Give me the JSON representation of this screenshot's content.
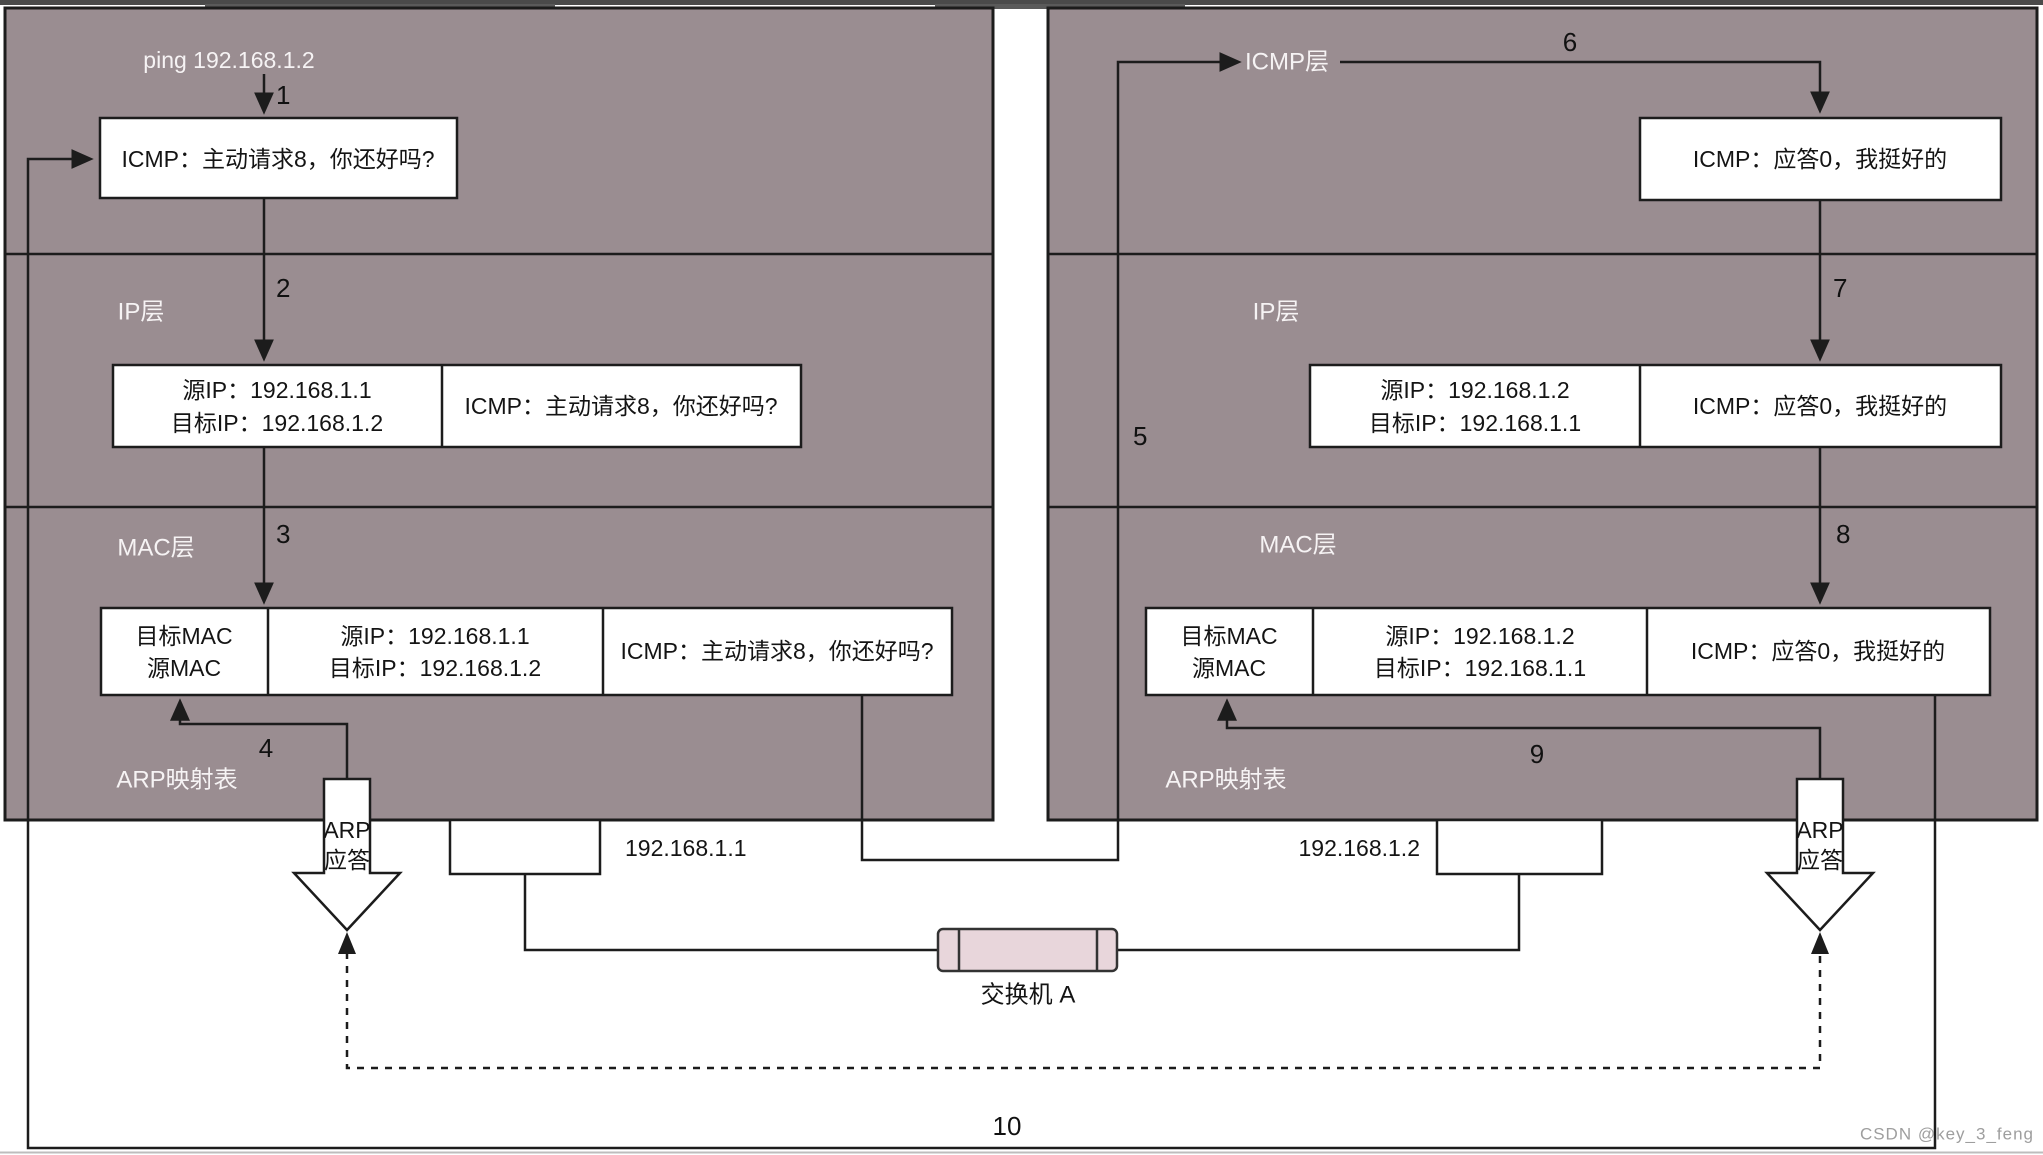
{
  "watermark": "CSDN @key_3_feng",
  "switch": {
    "label": "交换机 A"
  },
  "steps": {
    "s1": "1",
    "s2": "2",
    "s3": "3",
    "s4": "4",
    "s5": "5",
    "s6": "6",
    "s7": "7",
    "s8": "8",
    "s9": "9",
    "s10": "10"
  },
  "left_host": {
    "ping_label": "ping 192.168.1.2",
    "ip_layer_label": "IP层",
    "mac_layer_label": "MAC层",
    "arp_table_label": "ARP映射表",
    "nic_label": "192.168.1.1",
    "icmp_box": {
      "payload": "ICMP：主动请求8，你还好吗?"
    },
    "ip_box": {
      "src": "源IP：192.168.1.1",
      "dst": "目标IP：192.168.1.2",
      "payload": "ICMP：主动请求8，你还好吗?"
    },
    "mac_box": {
      "dst_mac": "目标MAC",
      "src_mac": "源MAC",
      "src": "源IP：192.168.1.1",
      "dst": "目标IP：192.168.1.2",
      "payload": "ICMP：主动请求8，你还好吗?"
    },
    "arp_reply": {
      "line1": "ARP",
      "line2": "应答"
    }
  },
  "right_host": {
    "icmp_layer_label": "ICMP层",
    "ip_layer_label": "IP层",
    "mac_layer_label": "MAC层",
    "arp_table_label": "ARP映射表",
    "nic_label": "192.168.1.2",
    "icmp_box": {
      "payload": "ICMP：应答0，我挺好的"
    },
    "ip_box": {
      "src": "源IP：192.168.1.2",
      "dst": "目标IP：192.168.1.1",
      "payload": "ICMP：应答0，我挺好的"
    },
    "mac_box": {
      "dst_mac": "目标MAC",
      "src_mac": "源MAC",
      "src": "源IP：192.168.1.2",
      "dst": "目标IP：192.168.1.1",
      "payload": "ICMP：应答0，我挺好的"
    },
    "arp_reply": {
      "line1": "ARP",
      "line2": "应答"
    }
  },
  "colors": {
    "host_fill": "#9a8d91",
    "switch_fill": "#e8d6db",
    "line": "#1c1c1c",
    "white_text": "#f6f3f4",
    "top_strip": "#4a4a4a"
  }
}
